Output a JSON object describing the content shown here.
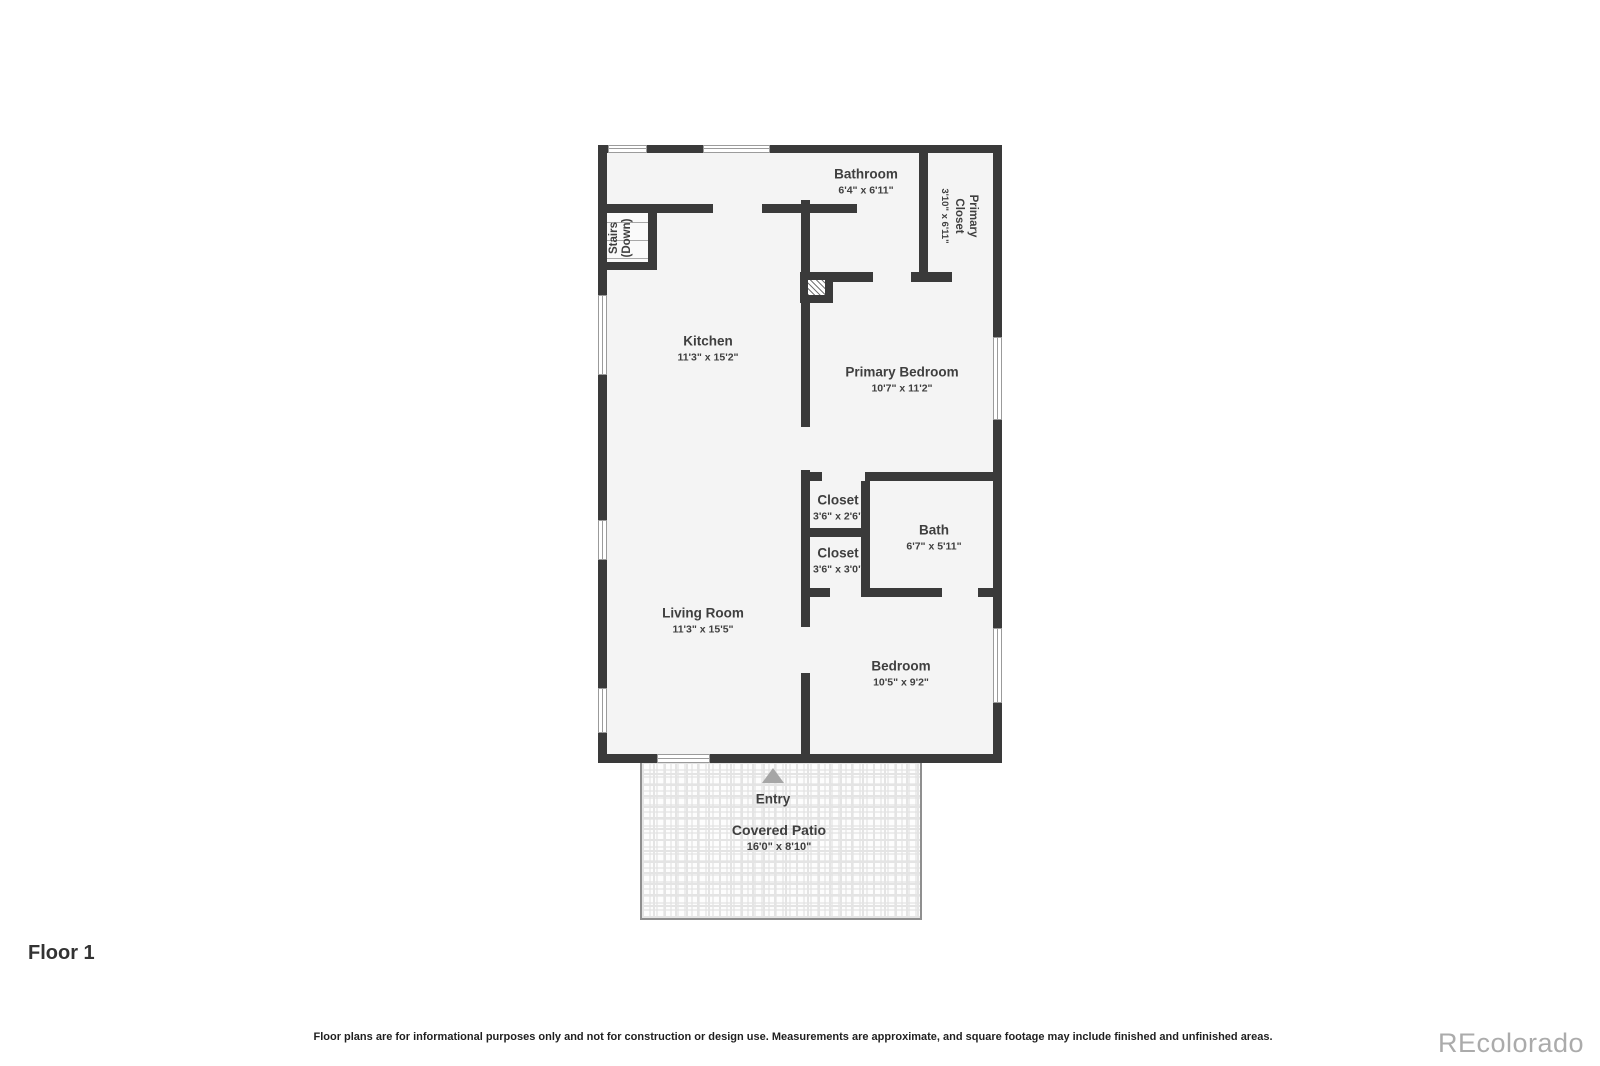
{
  "plan": {
    "rooms": {
      "kitchen": {
        "name": "Kitchen",
        "dims": "11'3\" x 15'2\""
      },
      "living_room": {
        "name": "Living Room",
        "dims": "11'3\" x 15'5\""
      },
      "bathroom": {
        "name": "Bathroom",
        "dims": "6'4\" x 6'11\""
      },
      "primary_closet": {
        "name": "Primary Closet",
        "dims": "3'10\" x 6'11\""
      },
      "primary_bedroom": {
        "name": "Primary Bedroom",
        "dims": "10'7\" x 11'2\""
      },
      "closet_upper": {
        "name": "Closet",
        "dims": "3'6\" x 2'6\""
      },
      "bath": {
        "name": "Bath",
        "dims": "6'7\" x 5'11\""
      },
      "closet_lower": {
        "name": "Closet",
        "dims": "3'6\" x 3'0\""
      },
      "bedroom": {
        "name": "Bedroom",
        "dims": "10'5\" x 9'2\""
      },
      "stairs": {
        "name": "Stairs (Down)"
      },
      "entry": {
        "name": "Entry"
      },
      "covered_patio": {
        "name": "Covered Patio",
        "dims": "16'0\" x 8'10\""
      }
    },
    "colors": {
      "wall": "#3a3a3a",
      "room_fill": "#f4f4f4",
      "label_text": "#3f3f3f",
      "window_frame": "#9b9b9b",
      "patio_border": "#8f8f8f",
      "entry_arrow": "#a6a6a6",
      "brand_text": "#ababab"
    }
  },
  "footer": {
    "floor_label": "Floor 1",
    "disclaimer": "Floor plans are for informational purposes only and not for construction or design use. Measurements are approximate, and square footage may include finished and unfinished areas.",
    "brand": "REcolorado"
  }
}
